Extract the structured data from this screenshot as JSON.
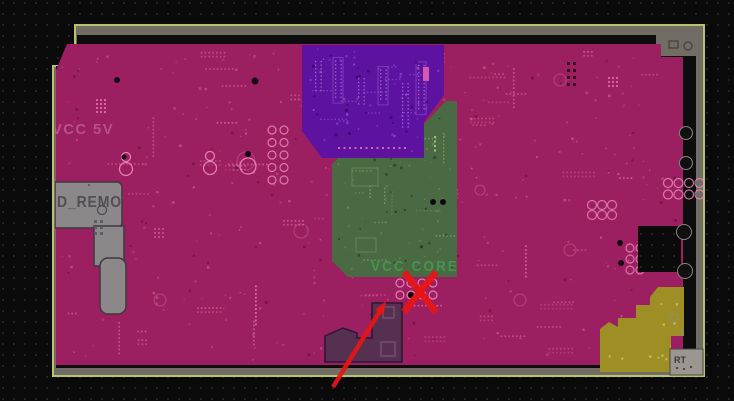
{
  "view": {
    "title": "PCB power plane layout view",
    "width": 734,
    "height": 401
  },
  "labels": {
    "vcc_5v": "VCC 5V",
    "gnd_remote": "ND_REMO",
    "vcc_core": "VCC CORE",
    "corner_ref": "RT"
  },
  "colors": {
    "background": "#0a0a0a",
    "grid_dot": "#262626",
    "board_border": "#716d64",
    "board_outline": "#b9c46a",
    "board_gap": "#0d0d0d",
    "plane_vcc5v": "#9c2061",
    "plane_purple": "#5e12a0",
    "plane_vcc_core": "#4a6a43",
    "plane_yellow": "#9d8f26",
    "plane_gnd": "#8c8789",
    "plane_dark": "#553050",
    "corner_block": "#9b968f",
    "text_vcc5v": "#c4639a",
    "text_core": "#44a052",
    "text_gnd": "#49454b",
    "text_ref": "#3b3835",
    "annotation_red": "#e81515"
  },
  "annotations": {
    "reject_mark": {
      "cx": 420,
      "cy": 292,
      "half_width": 16,
      "half_height": 20
    },
    "arrow": {
      "x1": 333,
      "y1": 387,
      "x2": 385,
      "y2": 303
    }
  }
}
